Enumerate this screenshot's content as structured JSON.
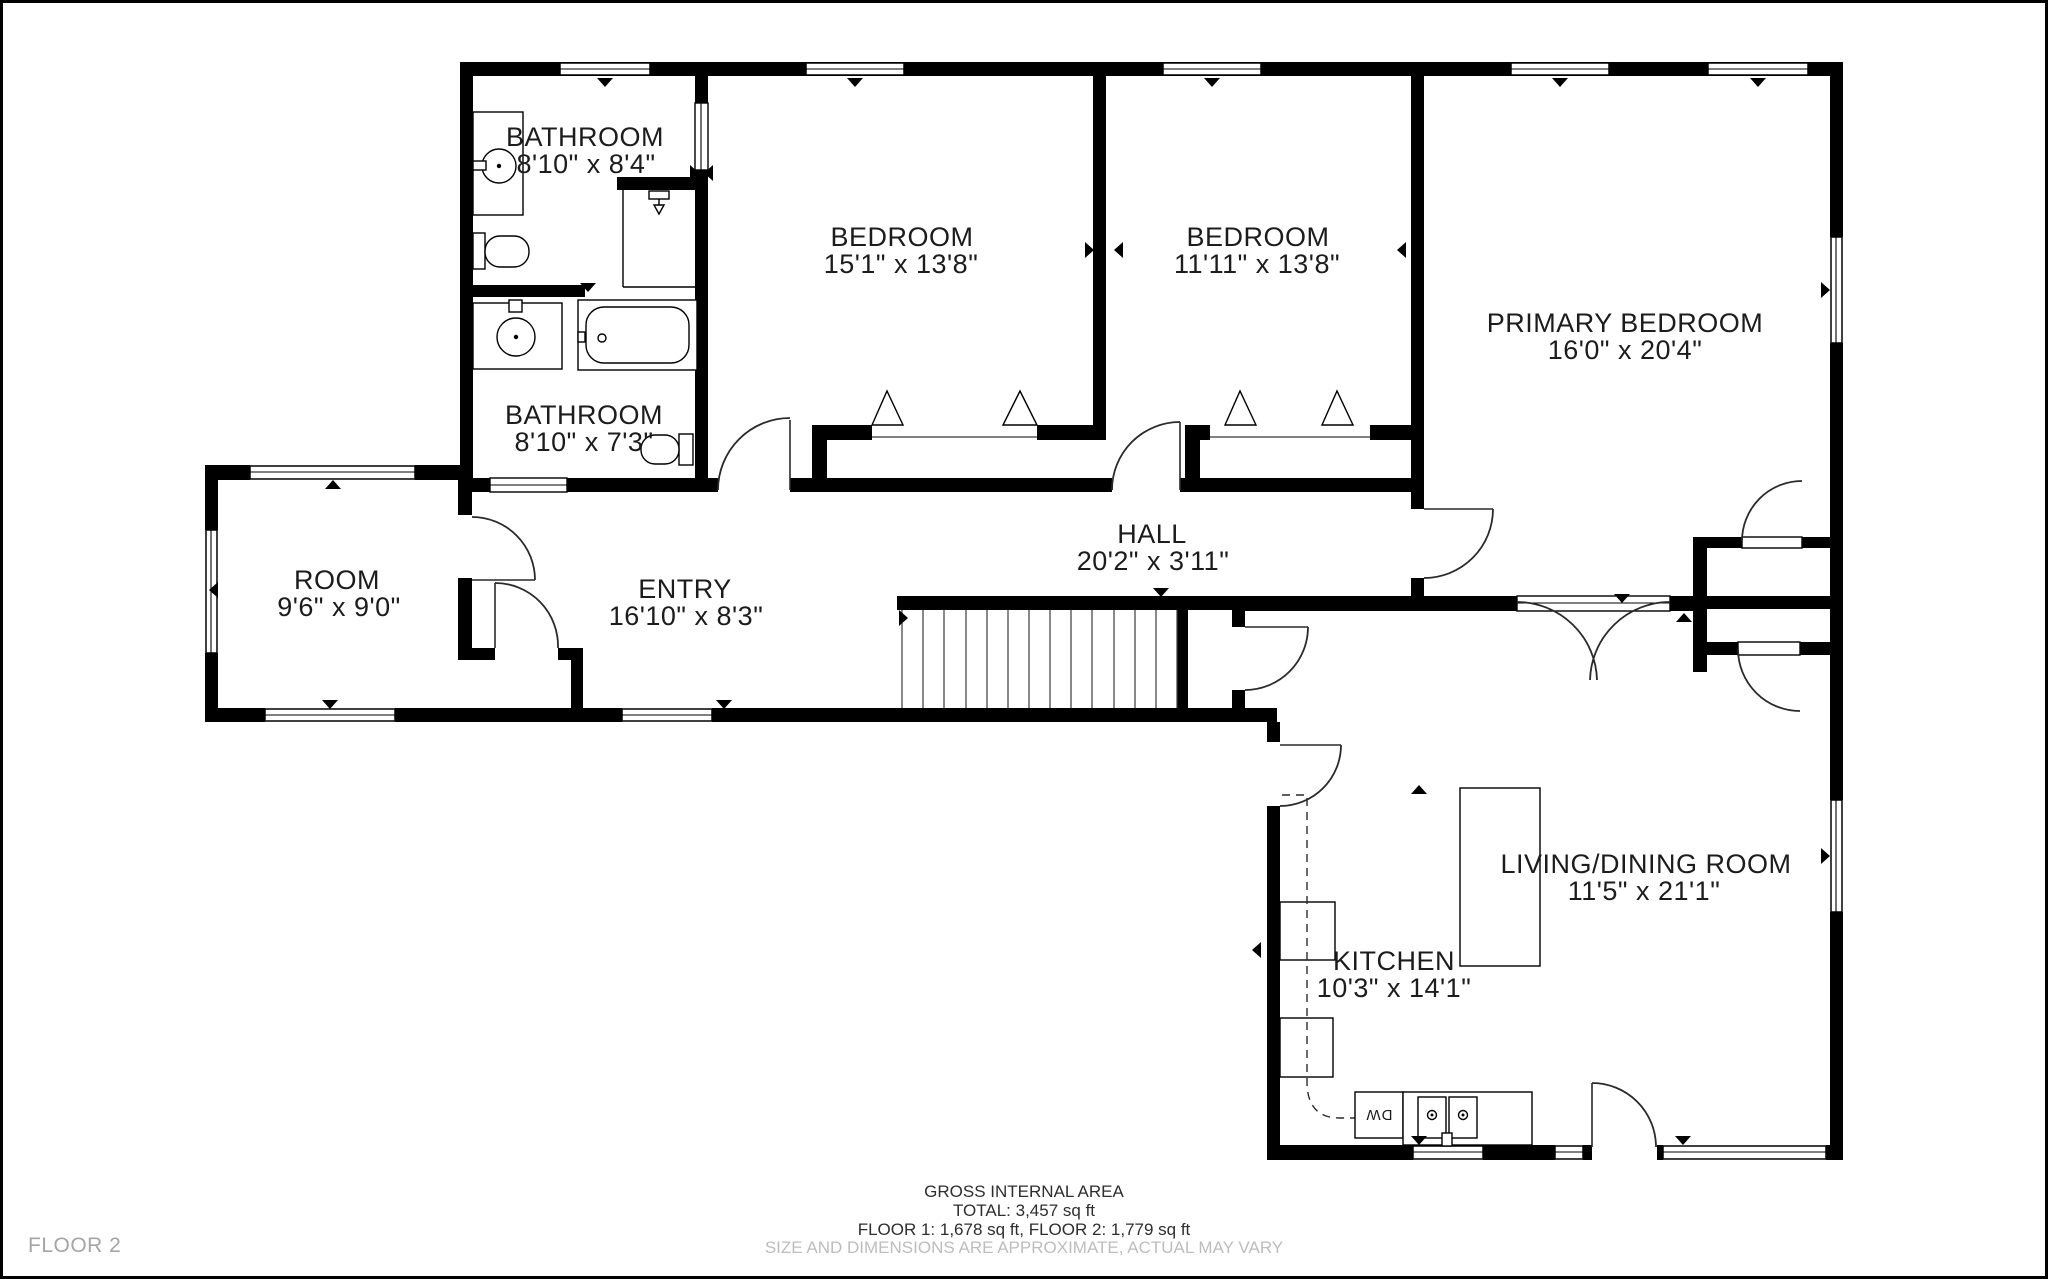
{
  "page": {
    "background": "#ffffff",
    "wall_color": "#000000",
    "muted_color": "#a5a5a5"
  },
  "floor_label": "FLOOR 2",
  "rooms": [
    {
      "id": "bathroom-upper",
      "name": "BATHROOM",
      "dims": "8'10\" x 8'4\""
    },
    {
      "id": "bathroom-lower",
      "name": "BATHROOM",
      "dims": "8'10\" x 7'3\""
    },
    {
      "id": "bedroom-left",
      "name": "BEDROOM",
      "dims": "15'1\" x 13'8\""
    },
    {
      "id": "bedroom-middle",
      "name": "BEDROOM",
      "dims": "11'11\" x 13'8\""
    },
    {
      "id": "primary-bedroom",
      "name": "PRIMARY BEDROOM",
      "dims": "16'0\" x 20'4\""
    },
    {
      "id": "room",
      "name": "ROOM",
      "dims": "9'6\" x 9'0\""
    },
    {
      "id": "entry",
      "name": "ENTRY",
      "dims": "16'10\" x 8'3\""
    },
    {
      "id": "hall",
      "name": "HALL",
      "dims": "20'2\" x 3'11\""
    },
    {
      "id": "kitchen",
      "name": "KITCHEN",
      "dims": "10'3\" x 14'1\""
    },
    {
      "id": "living-dining",
      "name": "LIVING/DINING ROOM",
      "dims": "11'5\" x 21'1\""
    }
  ],
  "appliances": {
    "dishwasher": "DW"
  },
  "footer": {
    "title": "GROSS INTERNAL AREA",
    "total": "TOTAL: 3,457 sq ft",
    "floors": "FLOOR 1: 1,678 sq ft, FLOOR 2: 1,779 sq ft",
    "disclaimer": "SIZE AND DIMENSIONS ARE APPROXIMATE, ACTUAL MAY VARY"
  }
}
